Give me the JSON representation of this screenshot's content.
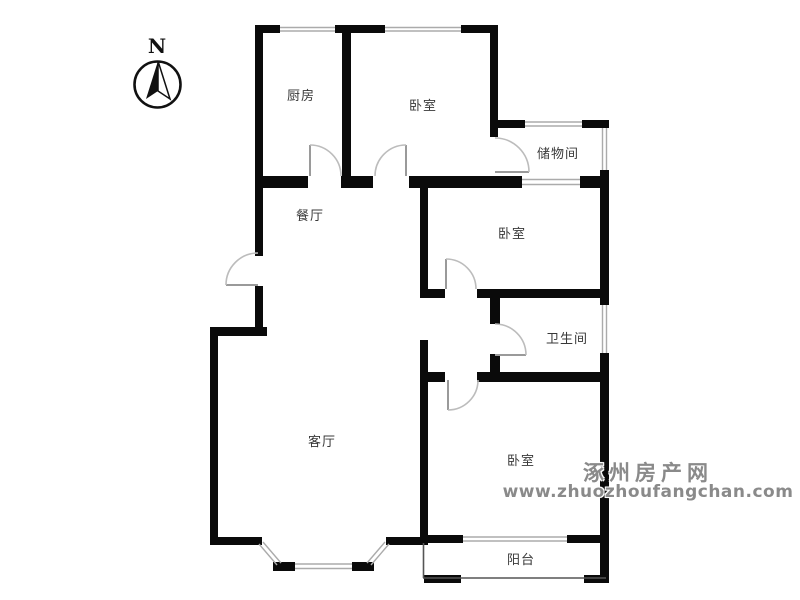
{
  "compass": {
    "label": "N"
  },
  "rooms": {
    "kitchen": {
      "label": "厨房"
    },
    "bedroom_top": {
      "label": "卧室"
    },
    "storage": {
      "label": "储物间"
    },
    "dining": {
      "label": "餐厅"
    },
    "bedroom_middle": {
      "label": "卧室"
    },
    "bathroom": {
      "label": "卫生间"
    },
    "living": {
      "label": "客厅"
    },
    "bedroom_bottom": {
      "label": "卧室"
    },
    "balcony": {
      "label": "阳台"
    }
  },
  "watermark": {
    "site_name": "涿州房产网",
    "url": "www.zhuozhoufangchan.com"
  },
  "colors": {
    "wall": "#0a0a0a",
    "door_arc": "#bcbcbc",
    "door_leaf": "#9a9a9a",
    "window_line": "#ababab",
    "thin_wall": "#555555",
    "label": "#383838",
    "watermark": "#8a8a8a"
  }
}
